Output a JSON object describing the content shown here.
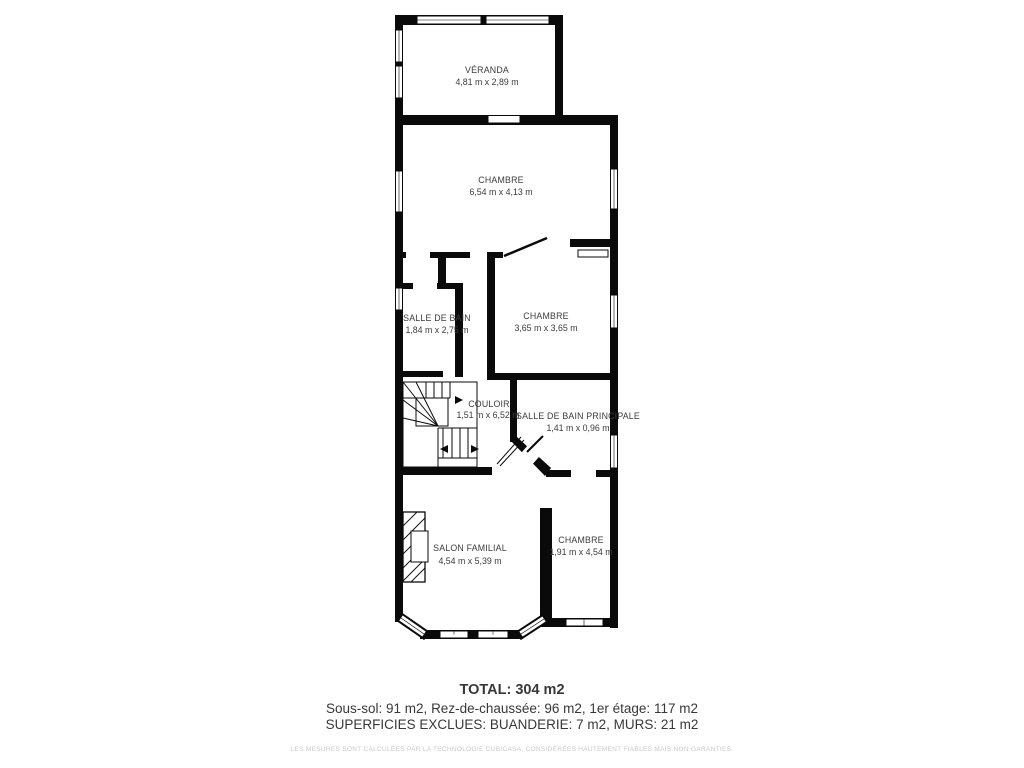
{
  "rooms": {
    "veranda": {
      "name": "VÉRANDA",
      "dims": "4,81 m x 2,89 m"
    },
    "chambre1": {
      "name": "CHAMBRE",
      "dims": "6,54 m x 4,13 m"
    },
    "salle_de_bain": {
      "name": "SALLE DE BAIN",
      "dims": "1,84 m x 2,75 m"
    },
    "chambre2": {
      "name": "CHAMBRE",
      "dims": "3,65 m x 3,65 m"
    },
    "couloir": {
      "name": "COULOIR",
      "dims": "1,51 m x 6,52 m"
    },
    "sdb_principale": {
      "name": "SALLE DE BAIN PRINCIPALE",
      "dims": "1,41 m x 0,96 m"
    },
    "salon": {
      "name": "SALON FAMILIAL",
      "dims": "4,54 m x 5,39 m"
    },
    "chambre3": {
      "name": "CHAMBRE",
      "dims": "1,91 m x 4,54 m"
    }
  },
  "summary": {
    "total": "TOTAL: 304 m2",
    "levels": "Sous-sol: 91 m2, Rez-de-chaussée: 96 m2, 1er étage: 117 m2",
    "exclusions": "SUPERFICIES EXCLUES: BUANDERIE: 7 m2, MURS: 21 m2"
  },
  "footer": {
    "disclaimer": "LES MESURES SONT CALCULÉES PAR LA TECHNOLOGIE CUBICASA. CONSIDÉRÉES HAUTEMENT FIABLES MAIS NON GARANTIES."
  },
  "colors": {
    "wall": "#0a0a0a",
    "label": "#3b3b3b",
    "summary_text": "#383838",
    "disclaimer_text": "#c9c9c9",
    "background": "#ffffff"
  }
}
